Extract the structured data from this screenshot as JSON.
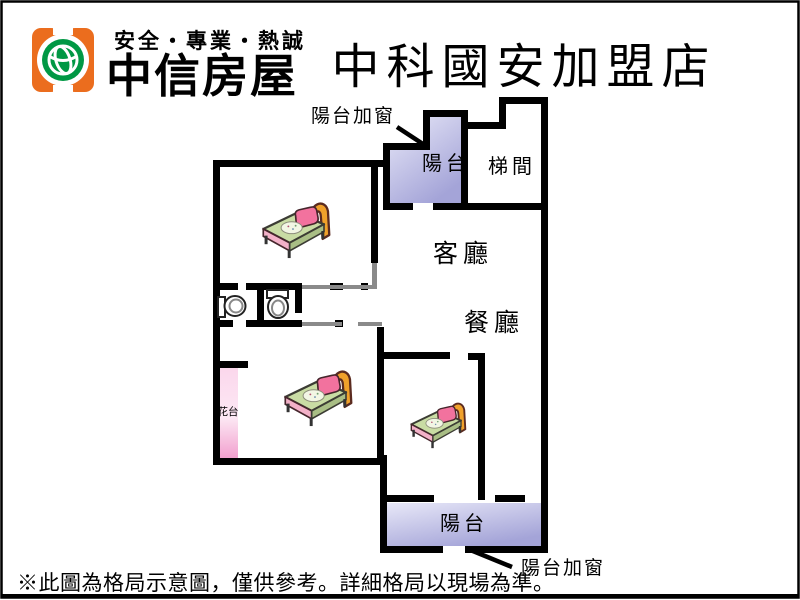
{
  "header": {
    "slogan": "安全・專業・熱誠",
    "brand_name": "中信房屋",
    "store_title": "中科國安加盟店"
  },
  "floorplan": {
    "labels": {
      "balcony_top": "陽台",
      "stairwell": "梯間",
      "living_room": "客廳",
      "dining_room": "餐廳",
      "flower_stand": "花台",
      "balcony_bottom": "陽台",
      "balcony_window_top": "陽台加窗",
      "balcony_window_bottom": "陽台加窗"
    },
    "icons": {
      "logo": "chinatrust-house-globe-logo",
      "bed": "single-bed-clipart",
      "toilet": "toilet-top-view"
    },
    "colors": {
      "brand_orange": "#EB6D1E",
      "brand_green": "#009844",
      "wall_black": "#000000",
      "wall_gray": "#8a8a8a",
      "balcony_light": "#e8e8f8",
      "balcony_dark": "#a4a4d8",
      "flower_light": "#fbd7ec",
      "flower_dark": "#f2a0ce"
    }
  },
  "footer": {
    "disclaimer": "※此圖為格局示意圖，僅供參考。詳細格局以現場為準。"
  }
}
